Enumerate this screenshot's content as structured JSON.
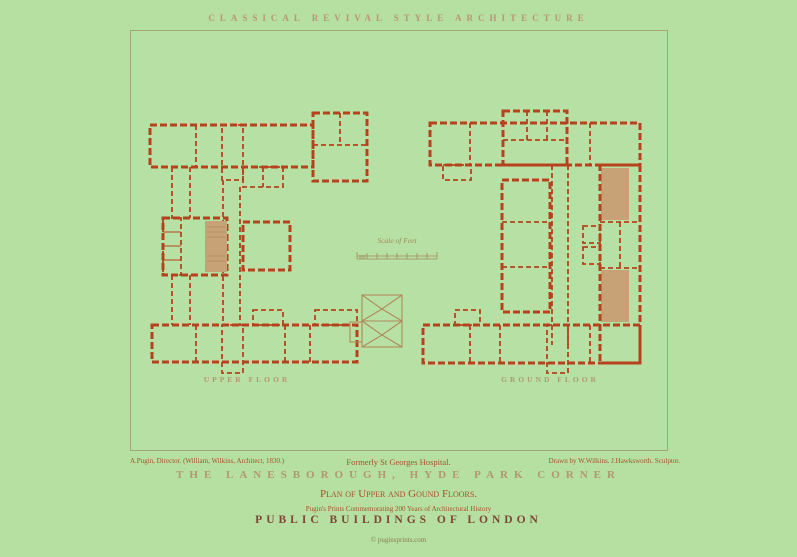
{
  "poster": {
    "header_title": "CLASSICAL REVIVAL STYLE ARCHITECTURE",
    "plans": {
      "left_label": "UPPER FLOOR",
      "right_label": "GROUND FLOOR",
      "scale_label": "Scale of Feet"
    },
    "credits": {
      "left": "A.Pugin, Director. (William, Wilkins, Architect, 1830.)",
      "center": "Formerly St Georges Hospital.",
      "right": "Drawn by W.Wilkins. J.Hawksworth. Sculptor."
    },
    "title": "THE LANESBOROUGH, HYDE PARK CORNER",
    "subtitle": "Plan of Upper and Gound Floors.",
    "series_note": "Pugin's Prints Commemorating 200 Years of Architectural History",
    "collection_title": "PUBLIC BUILDINGS OF LONDON",
    "copyright": "© puginsprints.com",
    "colors": {
      "background": "#b5e0a2",
      "frame_line": "#a2a578",
      "plan_red": "#b5421c",
      "shade_tan": "#c7a276",
      "roof_tan": "#b08a5a",
      "heading_tan": "#b39671",
      "text_red": "#a8502a",
      "collection_brown": "#7f4536",
      "copyright_olive": "#8d7a4e"
    }
  }
}
